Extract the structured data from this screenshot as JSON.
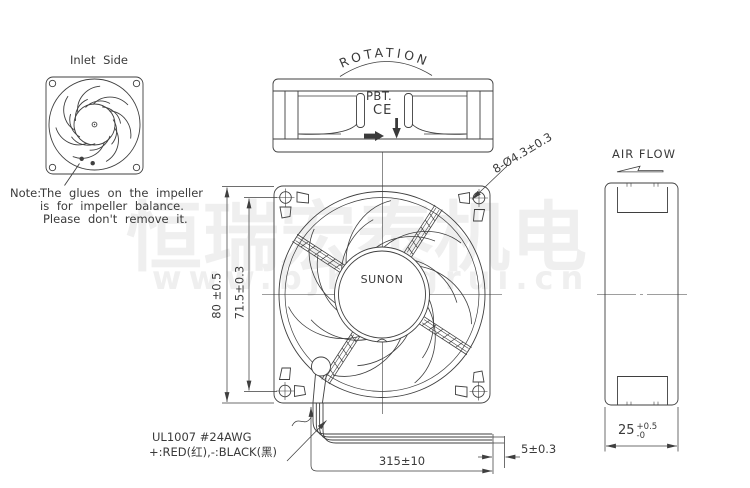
{
  "inlet_view": {
    "title": "Inlet Side"
  },
  "note": {
    "label": "Note:",
    "line1": "The glues on the impeller",
    "line2": "is for impeller balance.",
    "line3": "Please don't remove it."
  },
  "rotation_view": {
    "title": "ROTATION",
    "material": "PBT.",
    "ce_mark": "CE"
  },
  "main_view": {
    "brand": "SUNON"
  },
  "side_view": {
    "airflow_label": "AIR FLOW"
  },
  "dimensions": {
    "frame_height": "80 ±0.5",
    "hole_pitch": "71.5±0.3",
    "mounting_holes": "8-Ø4.3±0.3",
    "lead_length": "315±10",
    "strip_length": "5±0.3",
    "depth_value": "25",
    "depth_tol_plus": "+0.5",
    "depth_tol_minus": "-0"
  },
  "leads": {
    "line1": "UL1007 #24AWG",
    "line2": "+:RED(红),-:BLACK(黑)"
  },
  "watermark": {
    "line1": "恒瑞宏泰机电",
    "line2": "www.bjhengrui.cn"
  },
  "colors": {
    "line": "#3f3f3f",
    "text": "#3a3a3a",
    "watermark": "#efefef",
    "background": "#ffffff"
  }
}
